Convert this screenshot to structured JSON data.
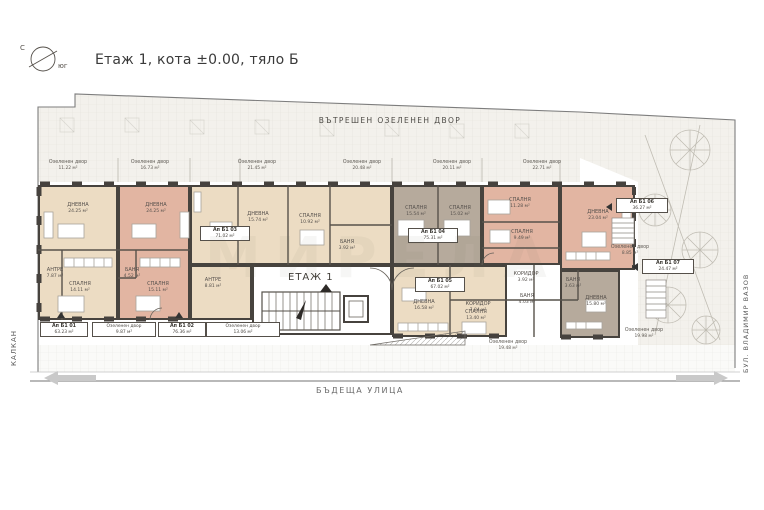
{
  "title": "Етаж 1, кота ±0.00, тяло Б",
  "compass": {
    "north": "С",
    "south": "юг"
  },
  "labels": {
    "inner_courtyard": "ВЪТРЕШЕН ОЗЕЛЕНЕН ДВОР",
    "future_street": "БЪДЕЩА УЛИЦА",
    "left_side": "КАЛКАН",
    "right_side": "БУЛ. ВЛАДИМИР ВАЗОВ",
    "floor_core": "ЕТАЖ 1",
    "watermark": "МИРЕЛА"
  },
  "colors": {
    "apartment_beige": "#ecdcc3",
    "apartment_salmon": "#e2b5a2",
    "apartment_taupe": "#b6aa9c",
    "walls": "#47433e",
    "courtyard": "#f3f1ec"
  },
  "top_yards": [
    {
      "label": "Озеленен двор",
      "area": "11.22 м²"
    },
    {
      "label": "Озеленен двор",
      "area": "16.73 м²"
    },
    {
      "label": "Озеленен двор",
      "area": "21.45 м²"
    },
    {
      "label": "Озеленен двор",
      "area": "20.48 м²"
    },
    {
      "label": "Озеленен двор",
      "area": "20.11 м²"
    },
    {
      "label": "Озеленен двор",
      "area": "22.71 м²"
    }
  ],
  "bottom_yards": [
    {
      "label": "Озеленен двор",
      "area": "9.87 м²"
    },
    {
      "label": "Озеленен двор",
      "area": "13.06 м²"
    },
    {
      "label": "Озеленен двор",
      "area": "19.48 м²"
    },
    {
      "label": "Озеленен двор",
      "area": "19.98 м²"
    }
  ],
  "side_yards": [
    {
      "label": "Озеленен двор",
      "area": "8.85 м²"
    }
  ],
  "apartments": [
    {
      "name": "Ап Б1 01",
      "area": "63.23 м²",
      "rooms": [
        {
          "label": "ДНЕВНА",
          "area": "24.25 м²"
        },
        {
          "label": "АНТРЕ",
          "area": "7.87 м²"
        },
        {
          "label": "СПАЛНЯ",
          "area": "14.11 м²"
        }
      ]
    },
    {
      "name": "Ап Б1 02",
      "area": "76.36 м²",
      "rooms": [
        {
          "label": "ДНЕВНА",
          "area": "24.25 м²"
        },
        {
          "label": "БАНЯ",
          "area": "4.52 м²"
        },
        {
          "label": "СПАЛНЯ",
          "area": "15.11 м²"
        }
      ]
    },
    {
      "name": "Ап Б1 03",
      "area": "71.02 м²",
      "rooms": [
        {
          "label": "ДНЕВНА",
          "area": "15.74 м²"
        },
        {
          "label": "СПАЛНЯ",
          "area": "10.92 м²"
        },
        {
          "label": "АНТРЕ",
          "area": "8.81 м²"
        },
        {
          "label": "БАНЯ",
          "area": "3.92 м²"
        }
      ]
    },
    {
      "name": "Ап Б1 04",
      "area": "75.31 м²",
      "rooms": [
        {
          "label": "СПАЛНЯ",
          "area": "15.54 м²"
        },
        {
          "label": "СПАЛНЯ",
          "area": "15.02 м²"
        }
      ]
    },
    {
      "name": "Ап Б1 05",
      "area": "67.02 м²",
      "rooms": [
        {
          "label": "ДНЕВНА",
          "area": "16.58 м²"
        },
        {
          "label": "КОРИДОР",
          "area": "7.84 м²"
        },
        {
          "label": "СПАЛНЯ",
          "area": "13.40 м²"
        }
      ]
    },
    {
      "name": "Ап Б1 06",
      "area": "36.27 м²",
      "rooms": [
        {
          "label": "СПАЛНЯ",
          "area": "11.28 м²"
        },
        {
          "label": "СПАЛНЯ",
          "area": "9.49 м²"
        },
        {
          "label": "КОРИДОР",
          "area": "3.92 м²"
        },
        {
          "label": "БАНЯ",
          "area": "4.03 м²"
        }
      ]
    },
    {
      "name": "Ап Б1 07",
      "area": "24.47 м²",
      "rooms": [
        {
          "label": "ДНЕВНА",
          "area": "23.04 м²"
        },
        {
          "label": "ДНЕВНА",
          "area": "15.80 м²"
        },
        {
          "label": "БАНЯ",
          "area": "3.63 м²"
        }
      ]
    }
  ]
}
